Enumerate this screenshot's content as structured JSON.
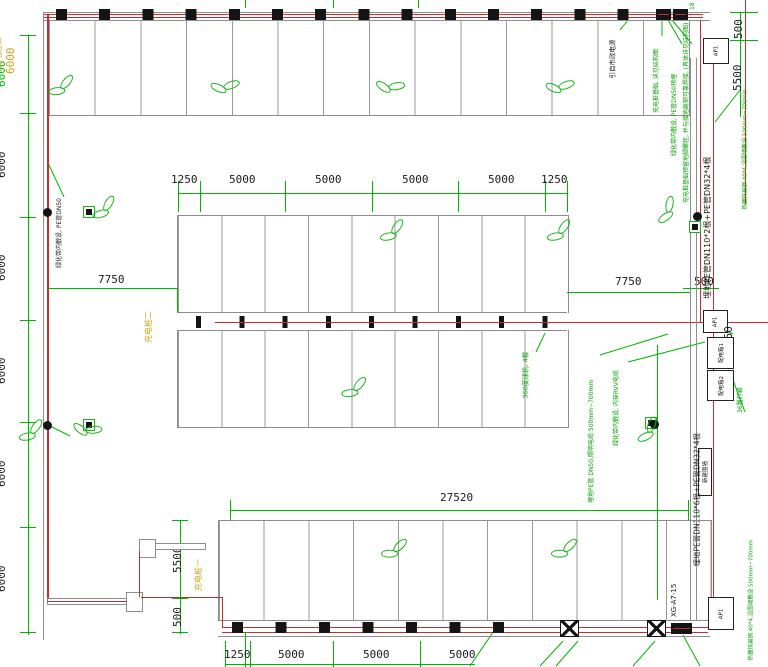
{
  "dims": {
    "left": [
      "6000",
      "6000",
      "6000",
      "6000",
      "6000",
      "6000"
    ],
    "left_overlay_yellow": "6000",
    "tr_500": "500",
    "tr_5500": "5500",
    "mid_top": [
      "1250",
      "5000",
      "5000",
      "5000",
      "5000",
      "1250"
    ],
    "left_7750": "7750",
    "right_7750": "7750",
    "right_500": "500",
    "right_450": "450",
    "bottom_27520": "27520",
    "bl_5500": "5500",
    "bl_500": "500",
    "bottom_row": [
      "1250",
      "5000",
      "5000",
      "5000"
    ]
  },
  "stations": {
    "one": "充电桩一",
    "two": "充电桩二",
    "three": "充电桩三"
  },
  "boxes": {
    "top_right": "AP1",
    "mid_top": "AP1",
    "dist1": "配电箱1",
    "dist2": "配电箱2",
    "bottom_right": "AP1",
    "wall": "新建围墙"
  },
  "annotations": {
    "power_source": "引自市政电源",
    "pile_foundation": "充电桩基础, 详见结构图",
    "green_belt_pipe": "绿化带内敷设, PE管DN50预埋",
    "ground_steel_weld": "充电桩基础预留地脚螺栓, 并与接地扁钢可靠焊接, (具体详见结构图)",
    "pipe_dn110_2": "埋地PE管DN110*2根+PE管DN32*4根",
    "pipe_dn110_6": "埋地PE管DN110*6根+PE管DN32*4根",
    "flat_steel_top": "热镀锌扁钢 40*4,沿围墙敷设 500mm~700mm",
    "flat_steel_bottom": "热镀锌扁钢 40*4,沿围墙敷设 500mm~700mm",
    "left_green_belt": "绿化带内敷设, PE管DN50",
    "camera": "360度球机, 4根",
    "lighting_pipe": "埋地PE管 DN50,照明电缆 500mm~700mm",
    "rvv_cable": "绿化带内敷设, 内穿RVV电缆",
    "lamp_box": "36路灯箱",
    "xg_ref": "XG-A7-15",
    "corner_18": "18"
  }
}
